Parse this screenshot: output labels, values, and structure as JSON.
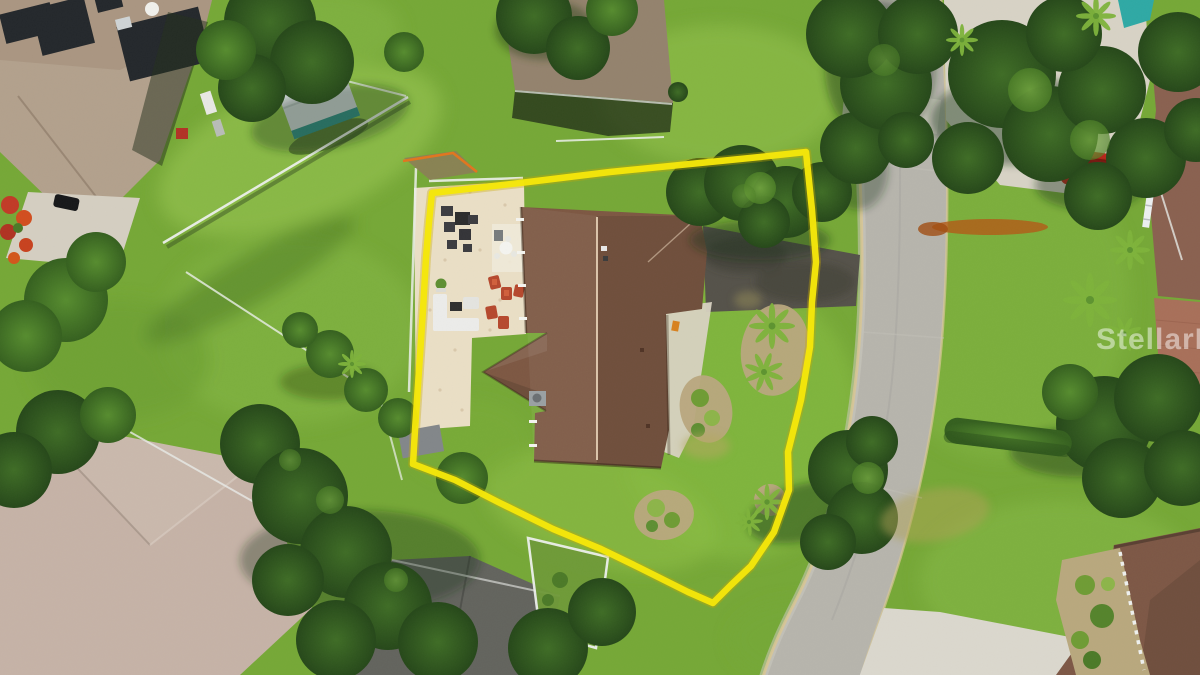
{
  "meta": {
    "type": "aerial-drone-photograph",
    "subject": "single-family home lot outlined with a yellow property-boundary overlay, suburban neighborhood, curving street on the right"
  },
  "watermark": {
    "text": "StellarMLS",
    "color": "#ffffff"
  },
  "boundary": {
    "color": "#f5e60a",
    "shape": "irregular lot outline drawn in yellow"
  },
  "palette": {
    "grass_base": "#76a837",
    "road": "#b7b5ad",
    "concrete": "#d8d4c8",
    "patio": "#eadfc6",
    "subject_roof": "#7d5843",
    "neighbor_roof_tan": "#b3a18d",
    "neighbor_roof_gray": "#94836e",
    "neighbor_roof_pink": "#c6b3a7",
    "neighbor_roof_dark": "#63645e",
    "brick_driveway": "#a8705a",
    "pool_water": "#2fa9a5",
    "solar_panel": "#24282c",
    "rust_stain": "#b35a17",
    "red_vehicle": "#c1271d",
    "white_fence": "#edf0ec"
  },
  "features": [
    "subject-house-brown-shingle-roof",
    "cream-paver-patio",
    "outdoor-dining-set",
    "white-sectional-sofa-set",
    "red-patio-chairs",
    "yellow-property-boundary-overlay",
    "asphalt-driveway",
    "front-walkway",
    "landscape-beds-with-palms",
    "magnolia-tree",
    "curving-street-with-curbs",
    "concrete-driveway-aprons",
    "irrigation-rust-stain-on-curb",
    "neighbor-house-with-solar-panels",
    "neighbor-shed-gray-roof",
    "neighbor-house-north",
    "neighbor-house-southwest",
    "neighbor-house-south-dark-roof",
    "fenced-garden-plot",
    "neighbor-house-east",
    "brick-paver-driveway",
    "swimming-pool-edge",
    "red-vehicle-under-trees",
    "white-ladder",
    "orange-silt-fence-on-dirt-patch",
    "white-pvc-fences",
    "lawns-and-tree-canopies",
    "stellar-mls-watermark"
  ]
}
